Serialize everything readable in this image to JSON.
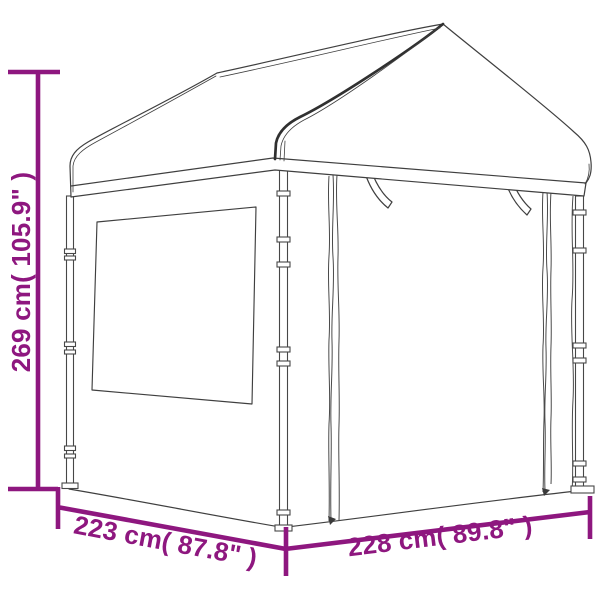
{
  "diagram": {
    "subject": "gazebo-canopy-line-drawing",
    "background": "#FFFFFF"
  },
  "colors": {
    "accent": "#8E177F",
    "line_art": "#3F3F3F"
  },
  "dimensions": {
    "height": {
      "label": "269 cm( 105.9\" )",
      "cm": "269",
      "inches": "105.9"
    },
    "depth": {
      "label": "223 cm( 87.8\" )",
      "cm": "223",
      "inches": "87.8"
    },
    "width": {
      "label": "228 cm( 89.8\" )",
      "cm": "228",
      "inches": "89.8"
    }
  }
}
